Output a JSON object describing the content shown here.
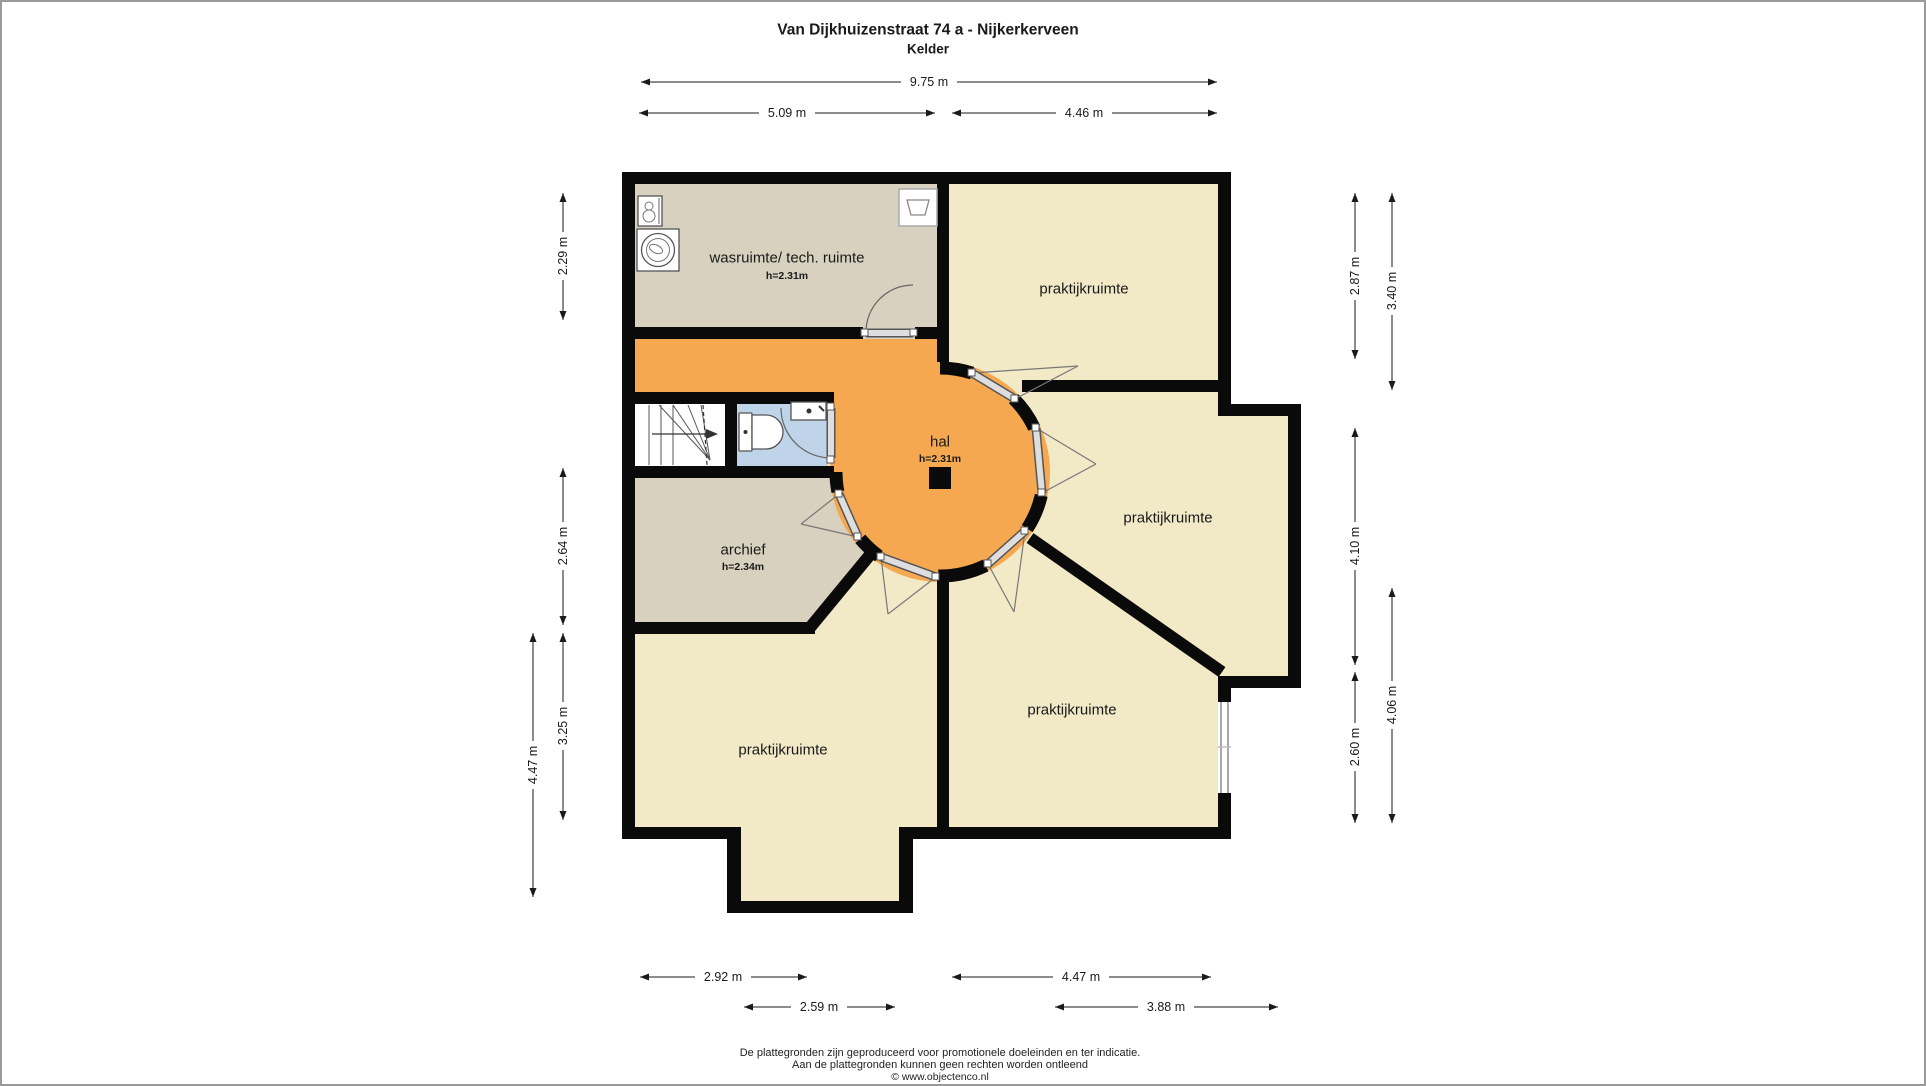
{
  "title": {
    "line1": "Van Dijkhuizenstraat 74 a - Nijkerkerveen",
    "line2": "Kelder"
  },
  "rooms": {
    "wasruimte": {
      "label": "wasruimte/ tech. ruimte",
      "ceiling_height": "h=2.31m"
    },
    "hal": {
      "label": "hal",
      "ceiling_height": "h=2.31m"
    },
    "archief": {
      "label": "archief",
      "ceiling_height": "h=2.34m"
    },
    "praktijkruimte_top_right": {
      "label": "praktijkruimte"
    },
    "praktijkruimte_middle_right": {
      "label": "praktijkruimte"
    },
    "praktijkruimte_bottom_middle": {
      "label": "praktijkruimte"
    },
    "praktijkruimte_bottom_left": {
      "label": "praktijkruimte"
    }
  },
  "dimensions": {
    "top": [
      {
        "label": "9.75 m"
      },
      {
        "label": "5.09 m"
      },
      {
        "label": "4.46 m"
      }
    ],
    "left": [
      {
        "label": "2.29 m"
      },
      {
        "label": "2.64 m"
      },
      {
        "label": "3.25 m"
      },
      {
        "label": "4.47 m"
      }
    ],
    "right": [
      {
        "label": "2.87 m"
      },
      {
        "label": "3.40 m"
      },
      {
        "label": "4.10 m"
      },
      {
        "label": "2.60 m"
      },
      {
        "label": "4.06 m"
      }
    ],
    "bottom": [
      {
        "label": "2.92 m"
      },
      {
        "label": "4.47 m"
      },
      {
        "label": "2.59 m"
      },
      {
        "label": "3.88 m"
      }
    ]
  },
  "footer": {
    "line1": "De plattegronden zijn geproduceerd voor promotionele doeleinden en ter indicatie.",
    "line2": "Aan de plattegronden kunnen geen rechten worden ontleend",
    "line3": "© www.objectenco.nl"
  },
  "colors": {
    "wall": "#0a0a0a",
    "hal_fill": "#f6a851",
    "room_fill_cream": "#f2e9c7",
    "room_fill_taupe": "#d9d1bf",
    "toilet_fill": "#bfd4e9",
    "stairs_fill": "#ffffff",
    "background": "#ffffff",
    "frame_border": "#9a9a9a"
  }
}
